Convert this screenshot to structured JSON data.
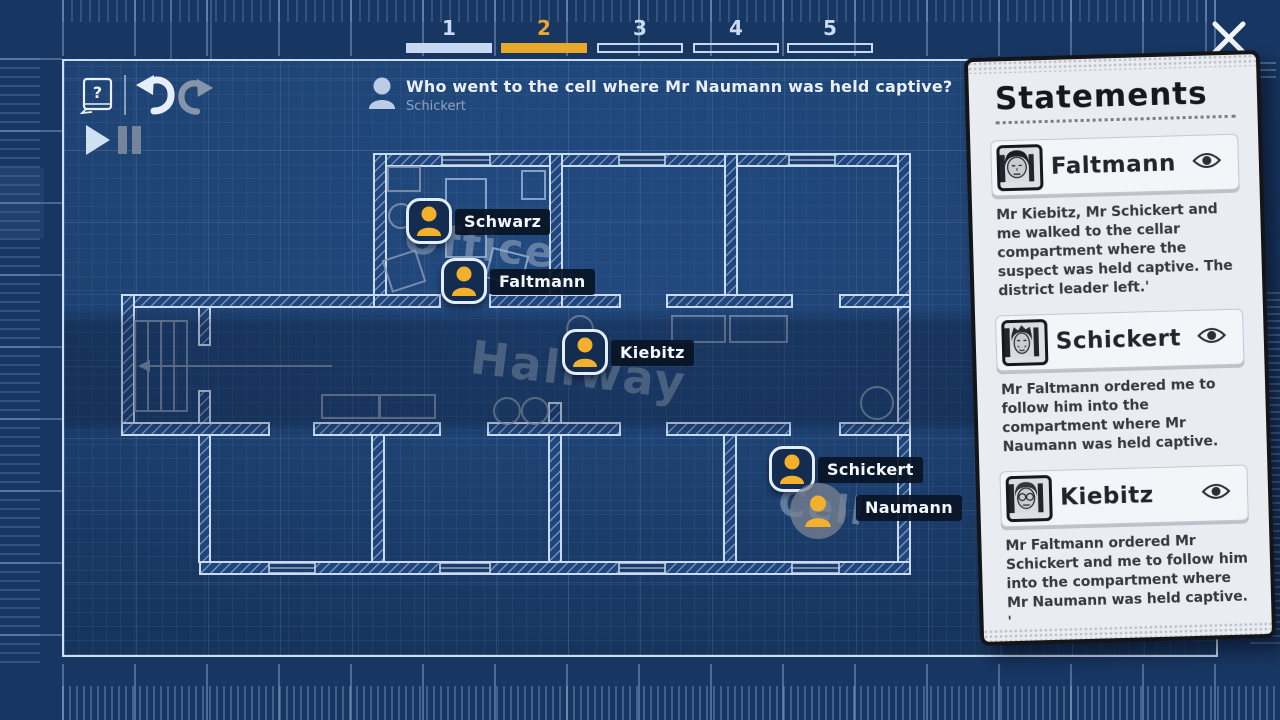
{
  "tabs": {
    "items": [
      {
        "label": "1",
        "state": "complete"
      },
      {
        "label": "2",
        "state": "active"
      },
      {
        "label": "3",
        "state": "empty"
      },
      {
        "label": "4",
        "state": "empty"
      },
      {
        "label": "5",
        "state": "empty"
      }
    ]
  },
  "toolbar": {
    "help_glyph": "?",
    "icons": [
      "help-book",
      "undo",
      "redo",
      "play",
      "pause"
    ]
  },
  "question": {
    "title": "Who went to the cell where Mr Naumann was held captive?",
    "answer": "Schickert"
  },
  "floorplan": {
    "rooms": [
      {
        "name": "Office"
      },
      {
        "name": "Hallway"
      },
      {
        "name": "Cell"
      }
    ],
    "characters": [
      {
        "name": "Schwarz"
      },
      {
        "name": "Faltmann"
      },
      {
        "name": "Kiebitz"
      },
      {
        "name": "Schickert"
      },
      {
        "name": "Naumann"
      }
    ]
  },
  "statements": {
    "title": "Statements",
    "items": [
      {
        "name": "Faltmann",
        "text": "Mr Kiebitz, Mr Schickert and me walked to the cellar compartment where the suspect was held captive. The district leader left.'"
      },
      {
        "name": "Schickert",
        "text": "Mr Faltmann ordered me to follow him into the compartment where Mr Naumann was held captive."
      },
      {
        "name": "Kiebitz",
        "text": "Mr Faltmann ordered Mr Schickert and me to follow him into the compartment where Mr Naumann was held captive. '"
      }
    ]
  },
  "colors": {
    "accent_gold": "#e8a82a",
    "blueprint_bg": "#1c4171",
    "paper": "#e9ecf1",
    "token_yellow": "#f2b02c"
  }
}
